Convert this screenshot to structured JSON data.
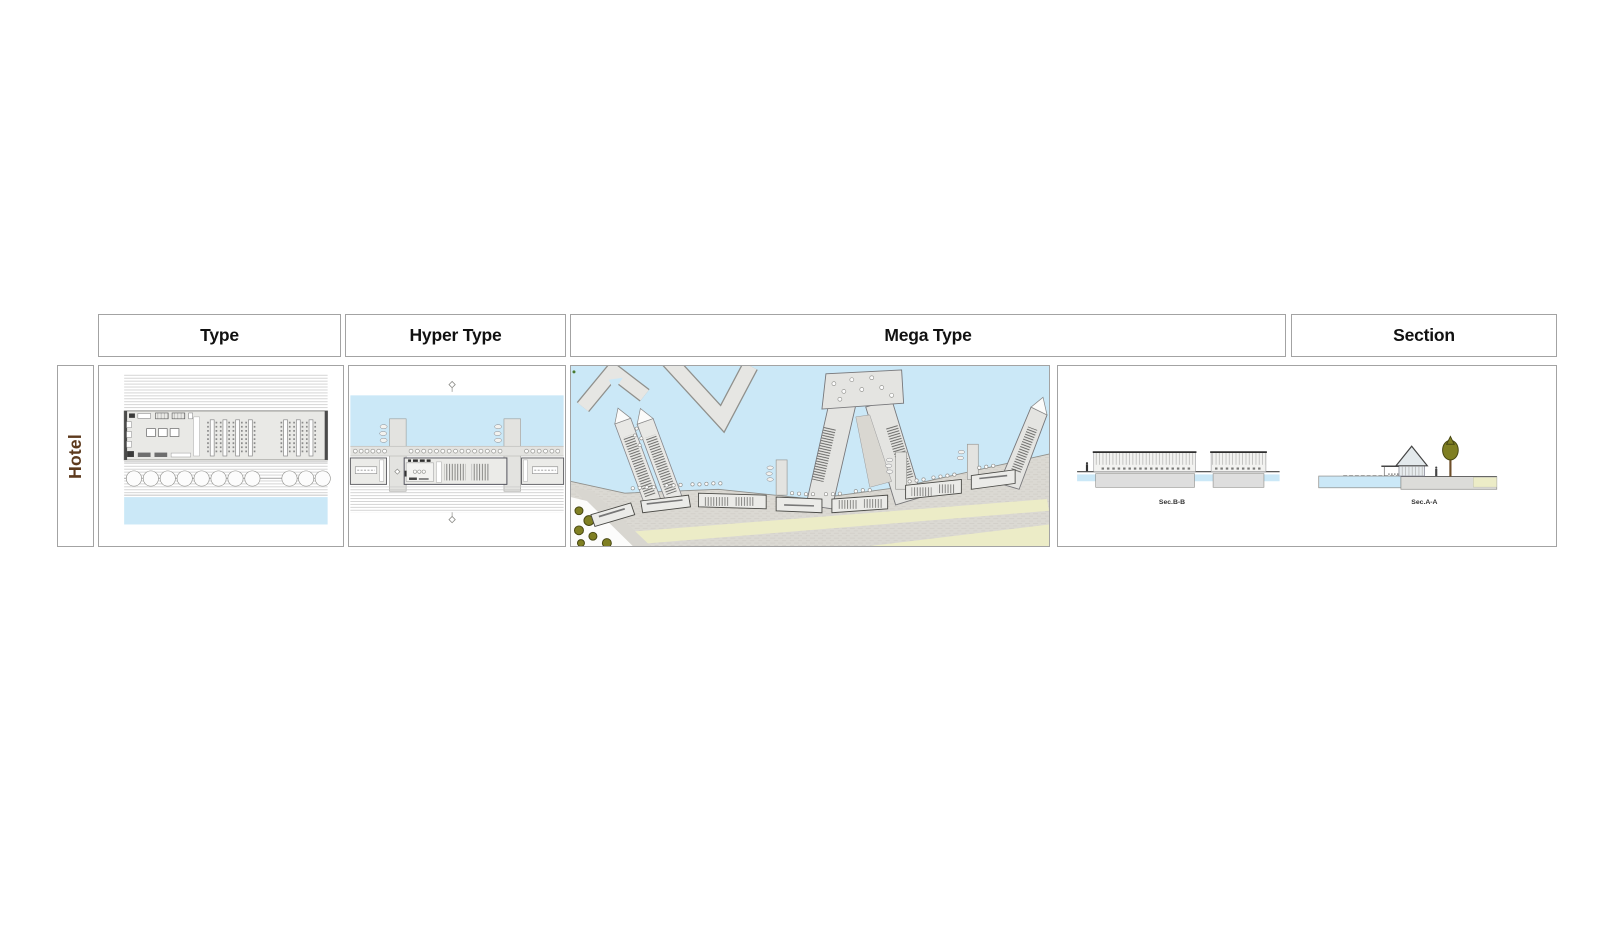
{
  "board": {
    "row_label": "Hotel",
    "columns": [
      {
        "id": "type",
        "label": "Type"
      },
      {
        "id": "hyper_type",
        "label": "Hyper Type"
      },
      {
        "id": "mega_type",
        "label": "Mega Type"
      },
      {
        "id": "section",
        "label": "Section"
      }
    ],
    "section_labels": {
      "sec_b": "Sec.B-B",
      "sec_a": "Sec.A-A"
    }
  },
  "colors": {
    "border": "#a3a3a3",
    "header_text": "#111111",
    "row_label_text": "#5d3a1d",
    "water": "#cbe8f7",
    "land": "#e6e6e3",
    "land_stroke": "#8a8a86",
    "promenade": "#dbd9d3",
    "lawn": "#ececc7",
    "tree": "#7f7f22",
    "tree_stroke": "#474712",
    "drawing_line": "#555555",
    "label_text": "#333333"
  }
}
